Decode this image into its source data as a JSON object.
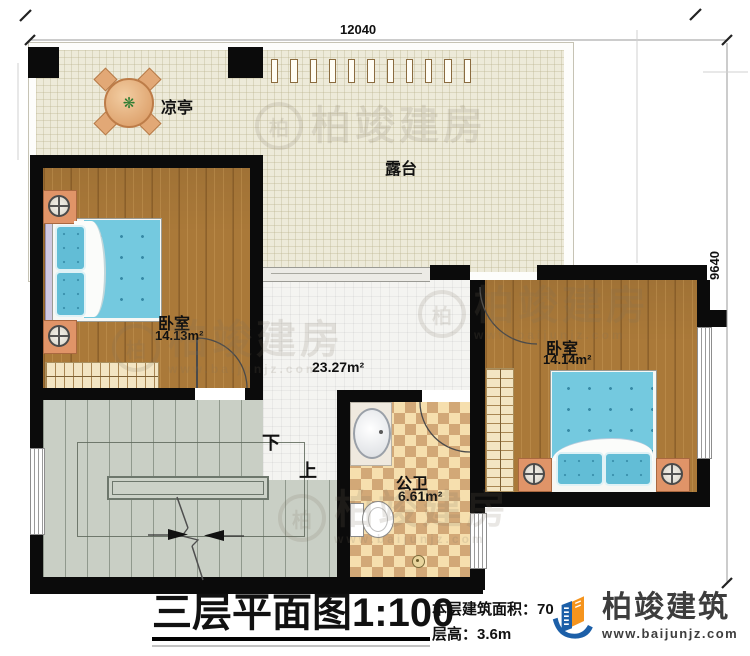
{
  "dimensions": {
    "top_width": "12040",
    "right_height": "9640"
  },
  "rooms": {
    "pavilion": {
      "label": "凉亭"
    },
    "terrace": {
      "label": "露台"
    },
    "bedroom_left": {
      "label": "卧室",
      "area": "14.13m²"
    },
    "bedroom_right": {
      "label": "卧室",
      "area": "14.14m²"
    },
    "hall": {
      "area": "23.27m²"
    },
    "bathroom": {
      "label": "公卫",
      "area": "6.61m²"
    }
  },
  "stairs": {
    "down": "下",
    "up": "上"
  },
  "title_block": {
    "title": "三层平面图",
    "scale": "1:100",
    "area_text": "本层建筑面积：70",
    "floor_height_text": "层高：3.6m"
  },
  "brand": {
    "name": "柏竣建筑",
    "website": "www.baijunjz.com"
  },
  "watermark": {
    "name": "柏竣建房",
    "website": "www.baijunjz.com",
    "ring_glyph": "柏"
  },
  "icons": {
    "plant": "❋"
  },
  "colors": {
    "wall": "#0b0b0b",
    "wood_floor": "#aa7939",
    "terrace_floor": "#edead9",
    "stair_floor": "#c9cfc5",
    "bed_blue": "#74c9df",
    "checker_light": "#f6dfae",
    "checker_dark": "#d2a877",
    "brand_blue": "#1c5fa8",
    "brand_orange": "#f5941d"
  }
}
